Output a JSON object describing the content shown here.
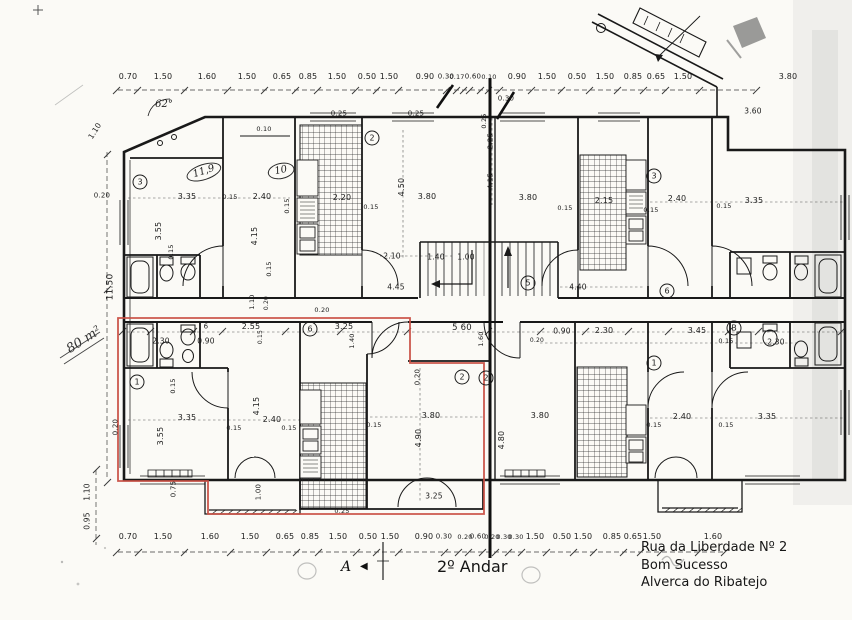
{
  "meta": {
    "floor_label": "2º Andar",
    "section_marker": "A",
    "area_note": "80 m²"
  },
  "address": {
    "line1": "Rua da Liberdade Nº 2",
    "line2": "Bom Sucesso",
    "line3": "Alverca do Ribatejo"
  },
  "colors": {
    "paper": "#fbfaf6",
    "ink": "#1b1b1b",
    "unit_outline_red": "#c94f43",
    "smudge": "#9a9a9a"
  },
  "dimension_labels": [
    {
      "t": "0.70",
      "x": 128,
      "y": 77
    },
    {
      "t": "1.50",
      "x": 163,
      "y": 77
    },
    {
      "t": "1.60",
      "x": 207,
      "y": 77
    },
    {
      "t": "1.50",
      "x": 247,
      "y": 77
    },
    {
      "t": "0.65",
      "x": 282,
      "y": 77
    },
    {
      "t": "0.85",
      "x": 308,
      "y": 77
    },
    {
      "t": "1.50",
      "x": 337,
      "y": 77
    },
    {
      "t": "0.50",
      "x": 367,
      "y": 77
    },
    {
      "t": "1.50",
      "x": 389,
      "y": 77
    },
    {
      "t": "0.90",
      "x": 425,
      "y": 77
    },
    {
      "t": "0.30",
      "x": 446,
      "y": 77,
      "s": 7
    },
    {
      "t": "0.17",
      "x": 457,
      "y": 77,
      "s": 6.5
    },
    {
      "t": "0.60",
      "x": 473,
      "y": 77,
      "s": 7
    },
    {
      "t": "0.10",
      "x": 489,
      "y": 77,
      "s": 6.5
    },
    {
      "t": "0.90",
      "x": 517,
      "y": 77
    },
    {
      "t": "1.50",
      "x": 547,
      "y": 77
    },
    {
      "t": "0.50",
      "x": 577,
      "y": 77
    },
    {
      "t": "1.50",
      "x": 605,
      "y": 77
    },
    {
      "t": "0.85",
      "x": 633,
      "y": 77
    },
    {
      "t": "0.65",
      "x": 656,
      "y": 77
    },
    {
      "t": "1.50",
      "x": 683,
      "y": 77
    },
    {
      "t": "3.80",
      "x": 788,
      "y": 77
    },
    {
      "t": "0.30",
      "x": 506,
      "y": 99,
      "s": 7
    },
    {
      "t": "3.60",
      "x": 753,
      "y": 111,
      "s": 7.5
    },
    {
      "t": "0.70",
      "x": 128,
      "y": 537
    },
    {
      "t": "1.50",
      "x": 163,
      "y": 537
    },
    {
      "t": "1.60",
      "x": 210,
      "y": 537
    },
    {
      "t": "1.50",
      "x": 250,
      "y": 537
    },
    {
      "t": "0.65",
      "x": 285,
      "y": 537
    },
    {
      "t": "0.85",
      "x": 310,
      "y": 537
    },
    {
      "t": "1.50",
      "x": 338,
      "y": 537
    },
    {
      "t": "0.50",
      "x": 368,
      "y": 537
    },
    {
      "t": "1.50",
      "x": 390,
      "y": 537
    },
    {
      "t": "0.90",
      "x": 424,
      "y": 537
    },
    {
      "t": "0.30",
      "x": 444,
      "y": 537,
      "s": 7
    },
    {
      "t": "0.20",
      "x": 465,
      "y": 537,
      "s": 6.5
    },
    {
      "t": "0.60",
      "x": 478,
      "y": 537,
      "s": 7
    },
    {
      "t": "0.20",
      "x": 492,
      "y": 537,
      "s": 6.5
    },
    {
      "t": "0.30",
      "x": 504,
      "y": 537,
      "s": 6.5
    },
    {
      "t": "0.30",
      "x": 516,
      "y": 537,
      "s": 6.5
    },
    {
      "t": "1.50",
      "x": 535,
      "y": 537
    },
    {
      "t": "0.50",
      "x": 562,
      "y": 537
    },
    {
      "t": "1.50",
      "x": 583,
      "y": 537
    },
    {
      "t": "0.85",
      "x": 612,
      "y": 537
    },
    {
      "t": "0.65",
      "x": 633,
      "y": 537
    },
    {
      "t": "1.50",
      "x": 652,
      "y": 537
    },
    {
      "t": "1.60",
      "x": 713,
      "y": 537
    },
    {
      "t": "11.50",
      "x": 111,
      "y": 287,
      "r": -90,
      "s": 9
    },
    {
      "t": "1.10",
      "x": 95,
      "y": 131,
      "r": -58,
      "s": 7.5
    },
    {
      "t": "0.20",
      "x": 102,
      "y": 196,
      "s": 7
    },
    {
      "t": "1.10",
      "x": 87,
      "y": 492,
      "r": -90,
      "s": 7.5
    },
    {
      "t": "0.95",
      "x": 87,
      "y": 521,
      "r": -90,
      "s": 7.5
    },
    {
      "t": "3.35",
      "x": 187,
      "y": 197
    },
    {
      "t": "0.15",
      "x": 230,
      "y": 197,
      "s": 6.5
    },
    {
      "t": "2.40",
      "x": 262,
      "y": 197
    },
    {
      "t": "0.15",
      "x": 287,
      "y": 206,
      "r": -90,
      "s": 6.5
    },
    {
      "t": "3.55",
      "x": 159,
      "y": 231,
      "r": -90
    },
    {
      "t": "4.15",
      "x": 255,
      "y": 236,
      "r": -90
    },
    {
      "t": "0.15",
      "x": 171,
      "y": 252,
      "r": -90,
      "s": 6.5
    },
    {
      "t": "0.15",
      "x": 269,
      "y": 269,
      "r": -90,
      "s": 6.5
    },
    {
      "t": "0.10",
      "x": 264,
      "y": 129,
      "s": 6.5
    },
    {
      "t": "0.25",
      "x": 339,
      "y": 114,
      "s": 7
    },
    {
      "t": "0.25",
      "x": 416,
      "y": 114,
      "s": 7
    },
    {
      "t": "2.20",
      "x": 342,
      "y": 198
    },
    {
      "t": "0.15",
      "x": 371,
      "y": 207,
      "s": 6.5
    },
    {
      "t": "4.50",
      "x": 402,
      "y": 187,
      "r": -90
    },
    {
      "t": "3.80",
      "x": 427,
      "y": 197
    },
    {
      "t": "2.10",
      "x": 392,
      "y": 256,
      "s": 7.5
    },
    {
      "t": "1.40",
      "x": 436,
      "y": 257,
      "s": 7.5
    },
    {
      "t": "1.00",
      "x": 466,
      "y": 257,
      "s": 7.5
    },
    {
      "t": "3.80",
      "x": 528,
      "y": 198
    },
    {
      "t": "0.25",
      "x": 484,
      "y": 121,
      "r": -90,
      "s": 6.5
    },
    {
      "t": "2.25",
      "x": 491,
      "y": 141,
      "r": -90,
      "s": 7
    },
    {
      "t": "4.15",
      "x": 491,
      "y": 181,
      "r": -90,
      "s": 7
    },
    {
      "t": "2.15",
      "x": 604,
      "y": 201
    },
    {
      "t": "0.15",
      "x": 565,
      "y": 208,
      "s": 6.5
    },
    {
      "t": "0.15",
      "x": 651,
      "y": 210,
      "s": 6.5
    },
    {
      "t": "2.40",
      "x": 677,
      "y": 199
    },
    {
      "t": "0.15",
      "x": 724,
      "y": 206,
      "s": 6.5
    },
    {
      "t": "3.35",
      "x": 754,
      "y": 201
    },
    {
      "t": "6",
      "x": 206,
      "y": 327,
      "s": 7
    },
    {
      "t": "2.55",
      "x": 251,
      "y": 327
    },
    {
      "t": "0.90",
      "x": 206,
      "y": 341,
      "s": 7.5
    },
    {
      "t": "0.15",
      "x": 261,
      "y": 337,
      "r": -90,
      "s": 6
    },
    {
      "t": "1.10",
      "x": 252,
      "y": 302,
      "r": -90,
      "s": 6.5
    },
    {
      "t": "0.20",
      "x": 267,
      "y": 303,
      "r": -90,
      "s": 6
    },
    {
      "t": "0.20",
      "x": 322,
      "y": 310,
      "s": 6.5
    },
    {
      "t": "2.30",
      "x": 161,
      "y": 341,
      "s": 7.5
    },
    {
      "t": "3.25",
      "x": 344,
      "y": 327
    },
    {
      "t": "1.40",
      "x": 352,
      "y": 341,
      "r": -90,
      "s": 6.5
    },
    {
      "t": "5 60",
      "x": 462,
      "y": 328,
      "s": 8.5
    },
    {
      "t": "1.60",
      "x": 481,
      "y": 339,
      "r": -90,
      "s": 6.5
    },
    {
      "t": "4.45",
      "x": 396,
      "y": 287,
      "s": 7.5
    },
    {
      "t": "4.40",
      "x": 578,
      "y": 287,
      "s": 7.5
    },
    {
      "t": "0.90",
      "x": 562,
      "y": 331,
      "s": 7.5
    },
    {
      "t": "2.30",
      "x": 604,
      "y": 331
    },
    {
      "t": "3.45",
      "x": 697,
      "y": 331
    },
    {
      "t": "0.15",
      "x": 726,
      "y": 341,
      "s": 6.5
    },
    {
      "t": "0.20",
      "x": 537,
      "y": 341,
      "s": 6
    },
    {
      "t": "2.30",
      "x": 776,
      "y": 342,
      "s": 7.5
    },
    {
      "t": "0.15",
      "x": 173,
      "y": 386,
      "r": -90,
      "s": 6.5
    },
    {
      "t": "3.35",
      "x": 187,
      "y": 418
    },
    {
      "t": "3.55",
      "x": 161,
      "y": 436,
      "r": -90
    },
    {
      "t": "4.15",
      "x": 257,
      "y": 406,
      "r": -90
    },
    {
      "t": "2.40",
      "x": 272,
      "y": 420
    },
    {
      "t": "0.15",
      "x": 234,
      "y": 428,
      "s": 6.5
    },
    {
      "t": "0.15",
      "x": 289,
      "y": 428,
      "s": 6.5
    },
    {
      "t": "1.00",
      "x": 259,
      "y": 492,
      "r": -90,
      "s": 7
    },
    {
      "t": "0.75",
      "x": 174,
      "y": 489,
      "r": -90,
      "s": 7
    },
    {
      "t": "0.20",
      "x": 116,
      "y": 427,
      "r": -90,
      "s": 7
    },
    {
      "t": "0.20",
      "x": 418,
      "y": 377,
      "r": -90,
      "s": 7
    },
    {
      "t": "3.80",
      "x": 431,
      "y": 416
    },
    {
      "t": "0.15",
      "x": 374,
      "y": 425,
      "s": 6.5
    },
    {
      "t": "4.90",
      "x": 419,
      "y": 438,
      "r": -90
    },
    {
      "t": "3.25",
      "x": 434,
      "y": 496,
      "s": 7.5
    },
    {
      "t": "0.25",
      "x": 342,
      "y": 511,
      "s": 6.5
    },
    {
      "t": "3.80",
      "x": 540,
      "y": 416
    },
    {
      "t": "4.80",
      "x": 502,
      "y": 440,
      "r": -90
    },
    {
      "t": "2.40",
      "x": 682,
      "y": 417
    },
    {
      "t": "3.35",
      "x": 767,
      "y": 417
    },
    {
      "t": "0.15",
      "x": 654,
      "y": 425,
      "s": 6.5
    },
    {
      "t": "0.15",
      "x": 726,
      "y": 425,
      "s": 6.5
    }
  ],
  "room_markers": [
    {
      "t": "3",
      "x": 140,
      "y": 182
    },
    {
      "t": "2",
      "x": 372,
      "y": 138
    },
    {
      "t": "3",
      "x": 654,
      "y": 176
    },
    {
      "t": "5",
      "x": 528,
      "y": 283
    },
    {
      "t": "6",
      "x": 310,
      "y": 329
    },
    {
      "t": "6",
      "x": 667,
      "y": 291
    },
    {
      "t": "B",
      "x": 734,
      "y": 328
    },
    {
      "t": "1",
      "x": 137,
      "y": 382
    },
    {
      "t": "2",
      "x": 462,
      "y": 377
    },
    {
      "t": "2",
      "x": 486,
      "y": 378
    },
    {
      "t": "1",
      "x": 654,
      "y": 363
    }
  ],
  "hand_notes": [
    {
      "t": "11,9",
      "x": 204,
      "y": 172,
      "r": -18,
      "oval": true
    },
    {
      "t": "10",
      "x": 281,
      "y": 171,
      "r": -12,
      "oval": true
    },
    {
      "t": "62°",
      "x": 164,
      "y": 105
    }
  ]
}
